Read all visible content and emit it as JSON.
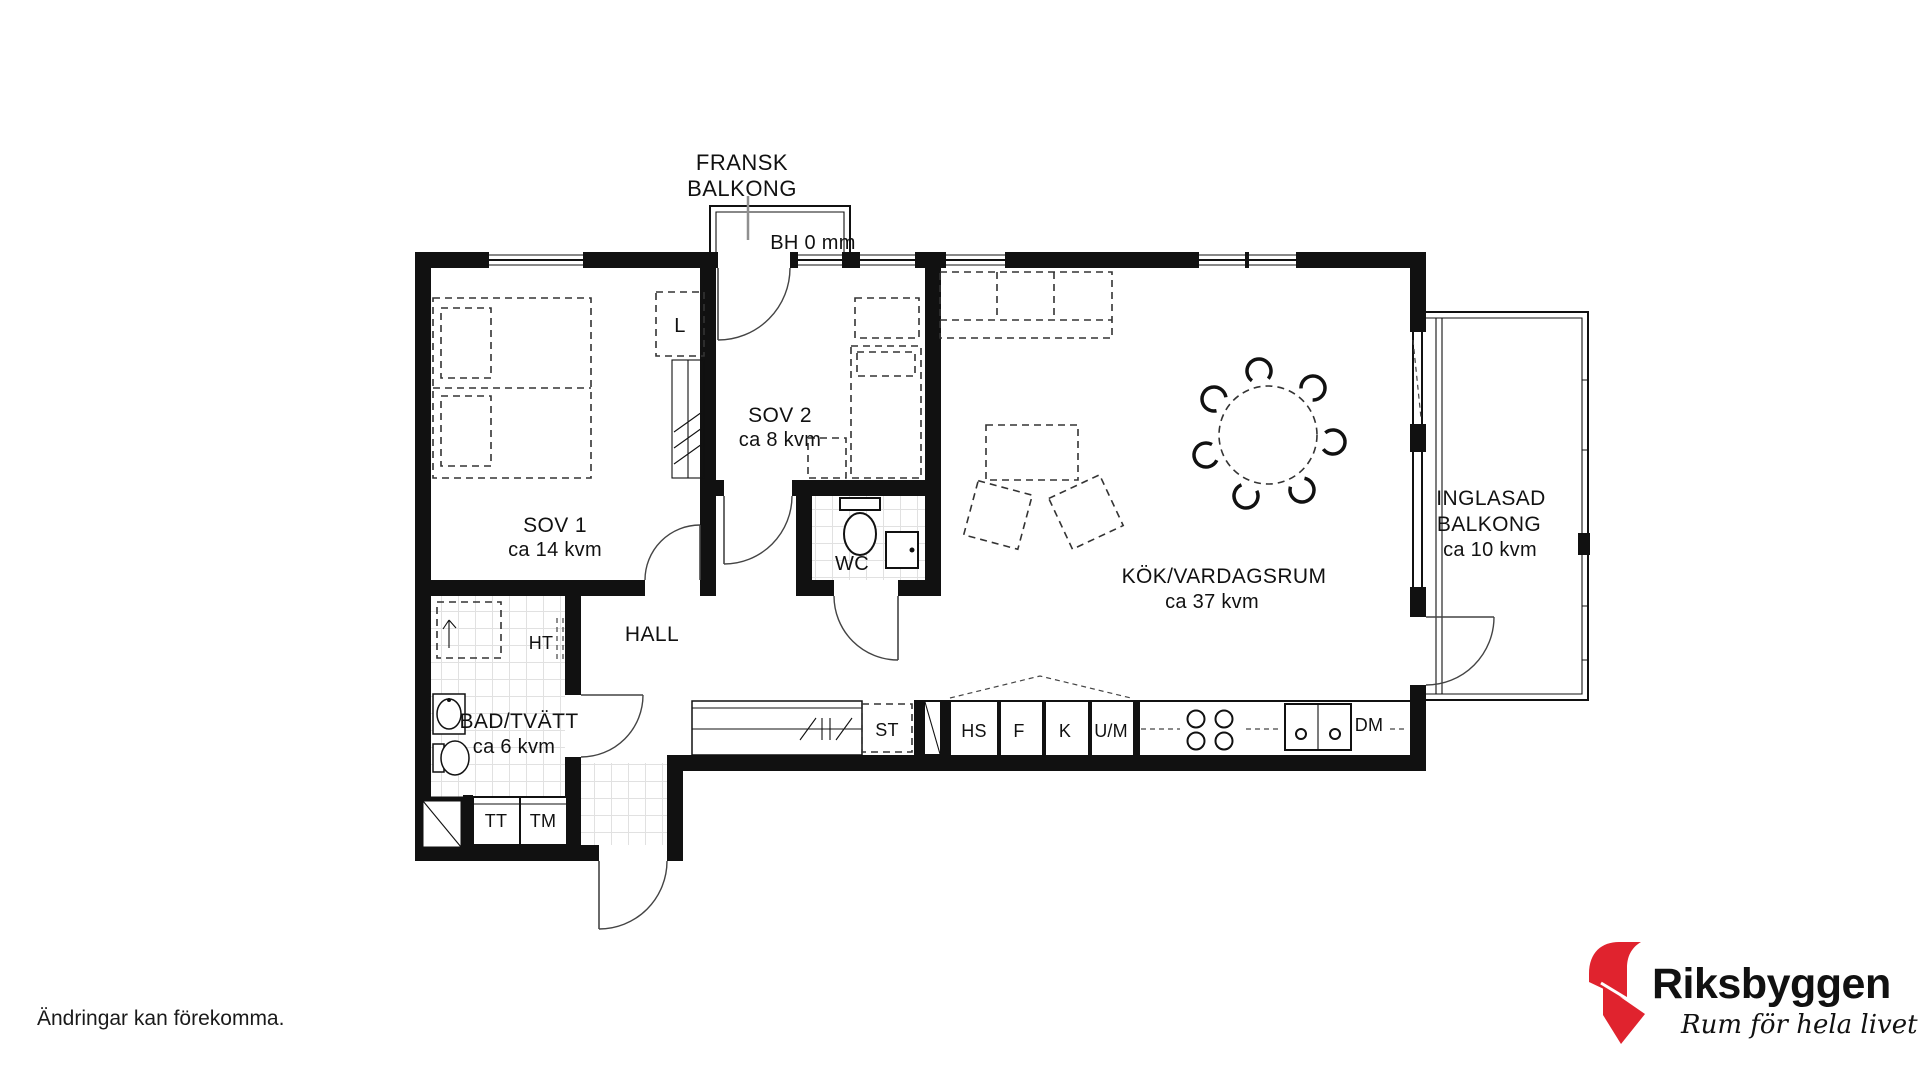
{
  "plan": {
    "balcony_top": {
      "label_line1": "FRANSK",
      "label_line2": "BALKONG",
      "height_note": "BH 0 mm"
    },
    "rooms": {
      "sov1": {
        "name": "SOV 1",
        "area": "ca 14 kvm"
      },
      "sov2": {
        "name": "SOV 2",
        "area": "ca 8 kvm"
      },
      "wc": {
        "name": "WC"
      },
      "hall": {
        "name": "HALL"
      },
      "bad_tvatt": {
        "name": "BAD/TVÄTT",
        "area": "ca 6 kvm"
      },
      "kok_vardagsrum": {
        "name": "KÖK/VARDAGSRUM",
        "area": "ca 37 kvm"
      },
      "inglasad_balkong": {
        "name_line1": "INGLASAD",
        "name_line2": "BALKONG",
        "area": "ca 10 kvm"
      }
    },
    "fixtures": {
      "l": "L",
      "ht": "HT",
      "tt": "TT",
      "tm": "TM",
      "st": "ST",
      "hs": "HS",
      "f": "F",
      "k": "K",
      "um": "U/M",
      "dm": "DM"
    }
  },
  "footer": {
    "disclaimer": "Ändringar kan förekomma."
  },
  "brand": {
    "name": "Riksbyggen",
    "tagline": "Rum för hela livet",
    "red": "#e0232e",
    "gray": "#98999b"
  }
}
